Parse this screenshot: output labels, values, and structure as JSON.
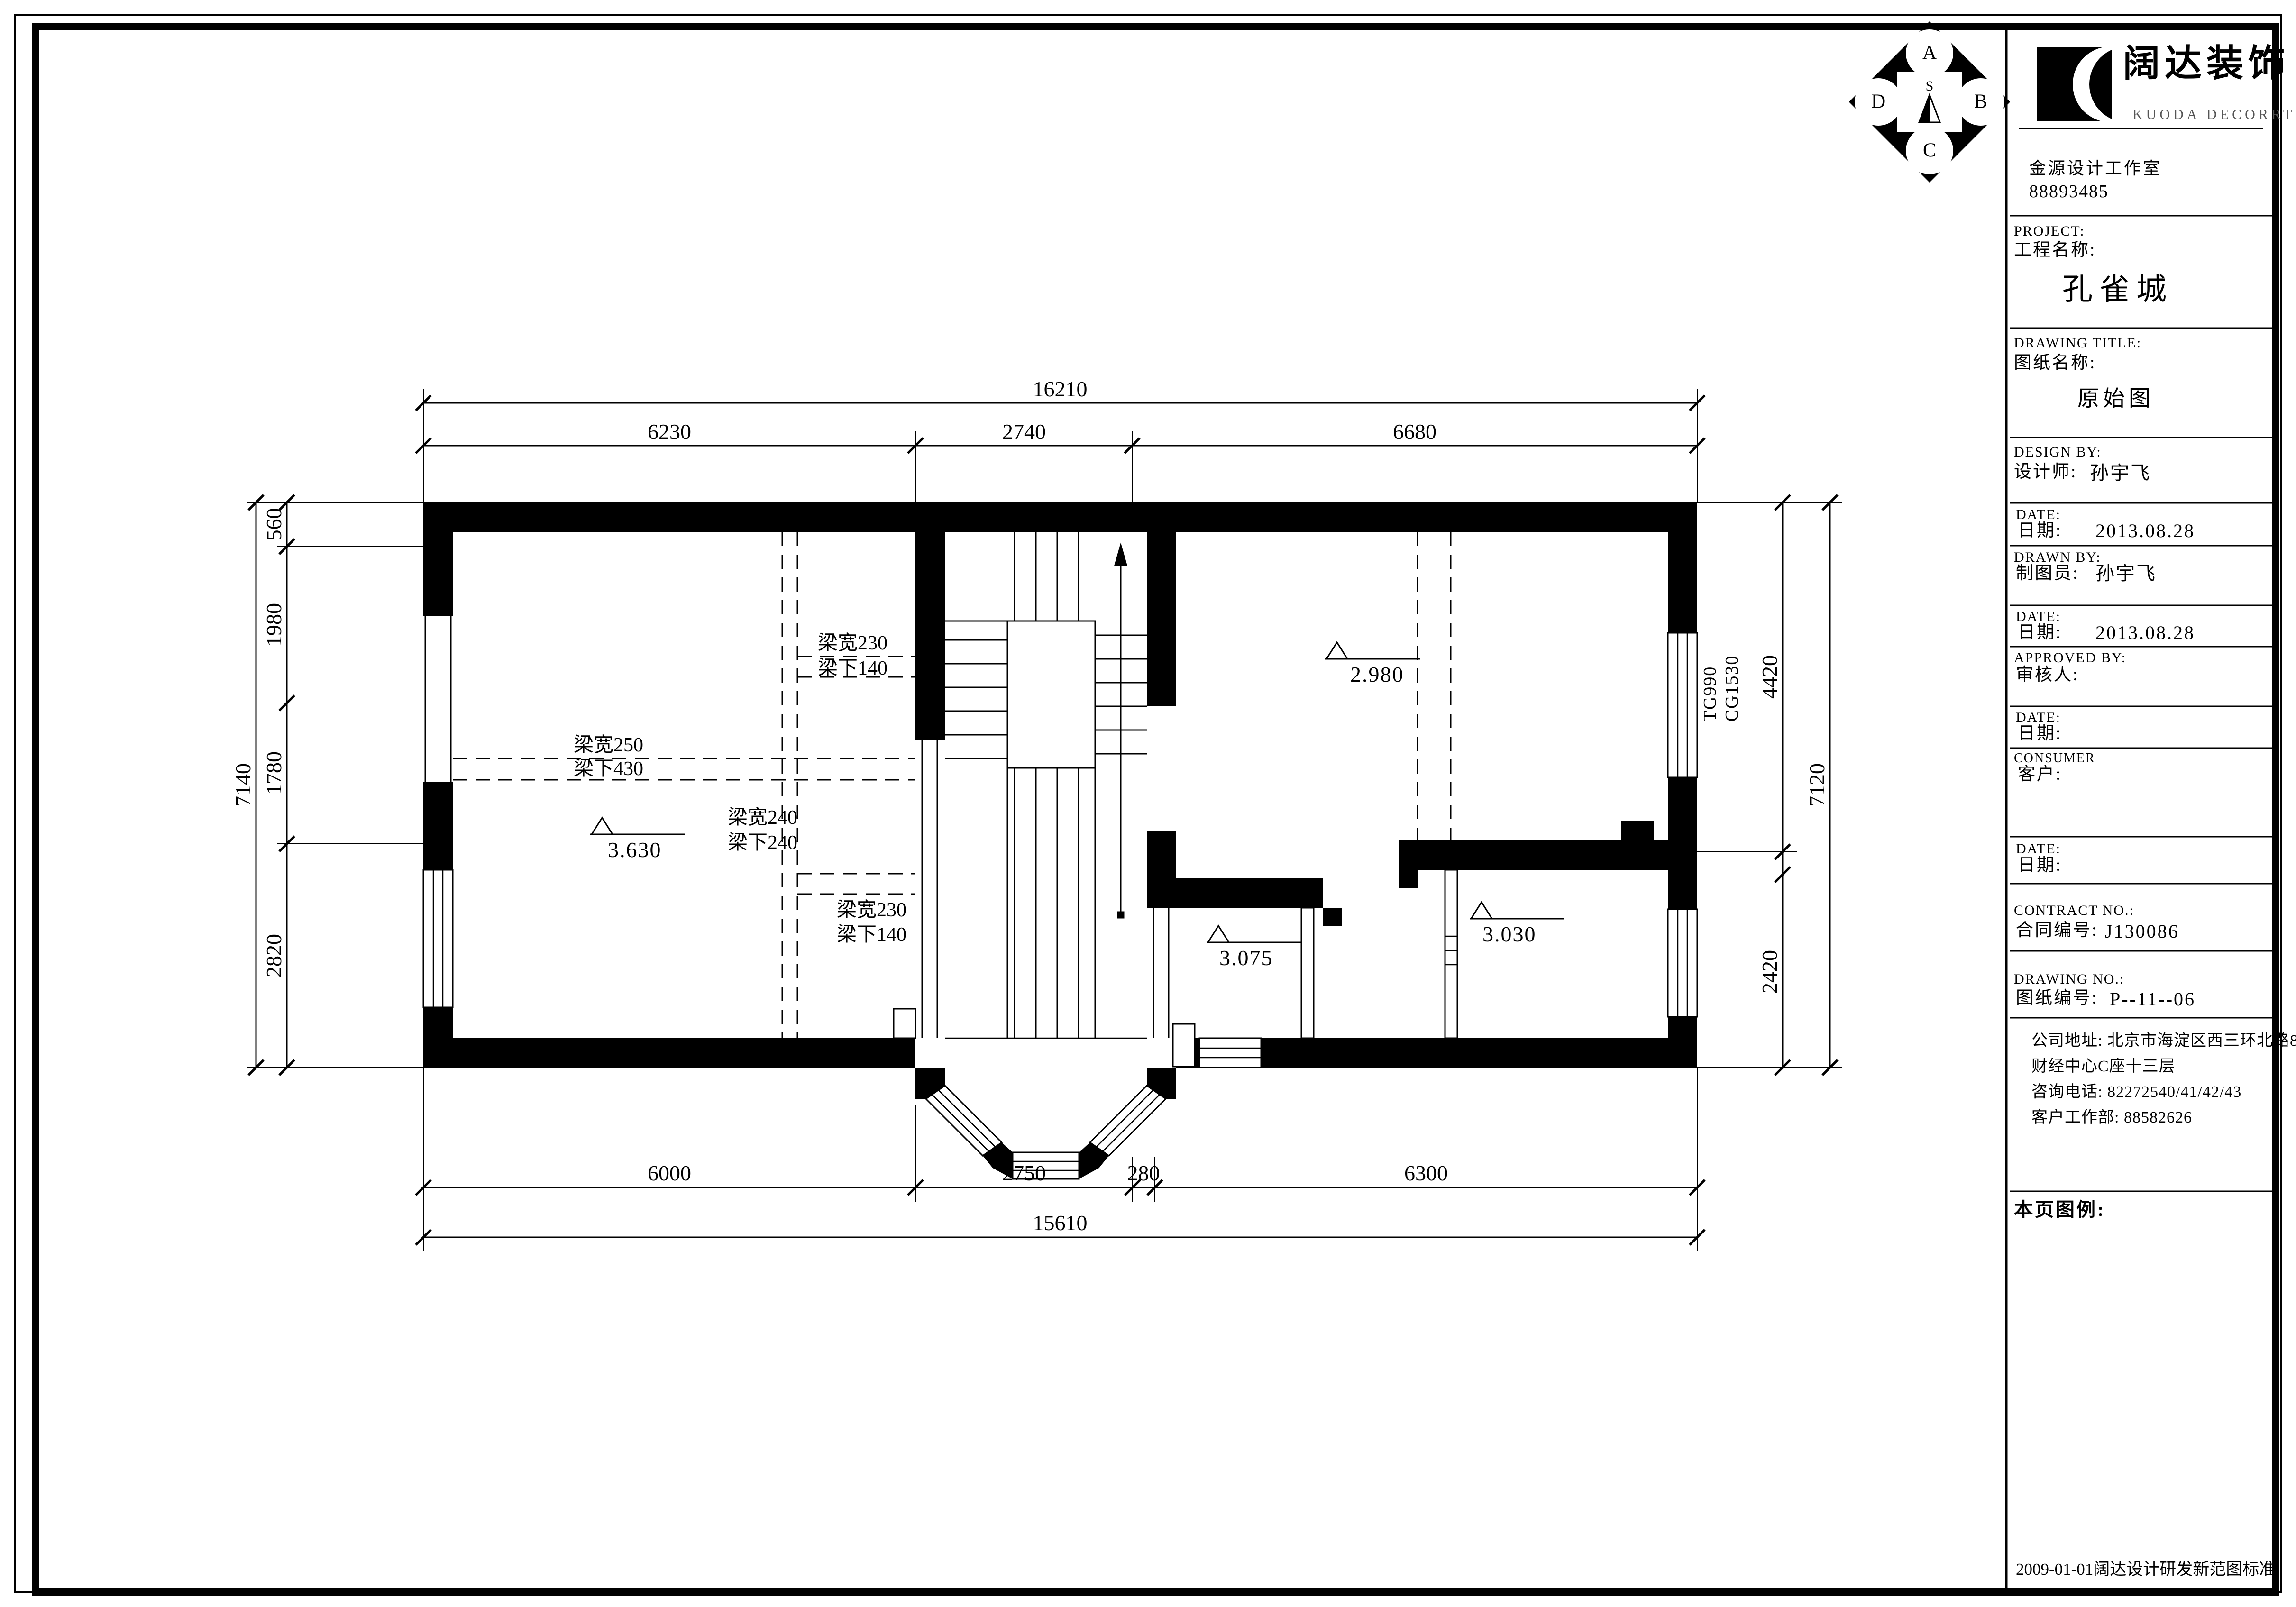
{
  "title_block": {
    "logo": {
      "brand_cn": "阔达装饰",
      "brand_en": "KUODA DECORRTION",
      "studio": "金源设计工作室",
      "studio_phone": "88893485"
    },
    "project": {
      "label_en": "PROJECT:",
      "label_cn": "工程名称:",
      "value": "孔雀城"
    },
    "drawing_title": {
      "label_en": "DRAWING TITLE:",
      "label_cn": "图纸名称:",
      "value": "原始图"
    },
    "design_by": {
      "label_en": "DESIGN BY:",
      "label_cn": "设计师:",
      "value": "孙宇飞"
    },
    "date1": {
      "label_en": "DATE:",
      "label_cn": "日期:",
      "value": "2013.08.28"
    },
    "drawn_by": {
      "label_en": "DRAWN BY:",
      "label_cn": "制图员:",
      "value": "孙宇飞"
    },
    "date2": {
      "label_en": "DATE:",
      "label_cn": "日期:",
      "value": "2013.08.28"
    },
    "approved_by": {
      "label_en": "APPROVED BY:",
      "label_cn": "审核人:",
      "value": ""
    },
    "date3": {
      "label_en": "DATE:",
      "label_cn": "日期:",
      "value": ""
    },
    "consumer": {
      "label_en": "CONSUMER",
      "label_cn": "客户:",
      "value": ""
    },
    "date4": {
      "label_en": "DATE:",
      "label_cn": "日期:",
      "value": ""
    },
    "contract": {
      "label_en": "CONTRACT NO.:",
      "label_cn": "合同编号:",
      "value": "J130086"
    },
    "drawing_no": {
      "label_en": "DRAWING NO.:",
      "label_cn": "图纸编号:",
      "value": "P--11--06"
    },
    "address_lines": [
      "公司地址: 北京市海淀区西三环北路87号国际",
      "财经中心C座十三层",
      "咨询电话: 82272540/41/42/43",
      "客户工作部: 88582626"
    ],
    "legend_label": "本页图例:",
    "footer_note": "2009-01-01阔达设计研发新范图标准"
  },
  "compass": {
    "letters": [
      "A",
      "B",
      "C",
      "D"
    ],
    "center": "S"
  },
  "plan": {
    "levels": [
      "3.630",
      "2.980",
      "3.075",
      "3.030"
    ],
    "beams": [
      {
        "w": "梁宽230",
        "d": "梁下140"
      },
      {
        "w": "梁宽250",
        "d": "梁下430"
      },
      {
        "w": "梁宽240",
        "d": "梁下240"
      },
      {
        "w": "梁宽230",
        "d": "梁下140"
      }
    ],
    "window_tags": "TG990\nCG1530",
    "dims": {
      "top_total": "16210",
      "top": [
        "6230",
        "2740",
        "6680"
      ],
      "bottom": [
        "6000",
        "2750",
        "280",
        "6300"
      ],
      "bottom_total": "15610",
      "left": [
        "560",
        "1980",
        "1780",
        "2820"
      ],
      "left_total": "7140",
      "right": [
        "4420",
        "2420"
      ],
      "right_total": "7120"
    }
  }
}
